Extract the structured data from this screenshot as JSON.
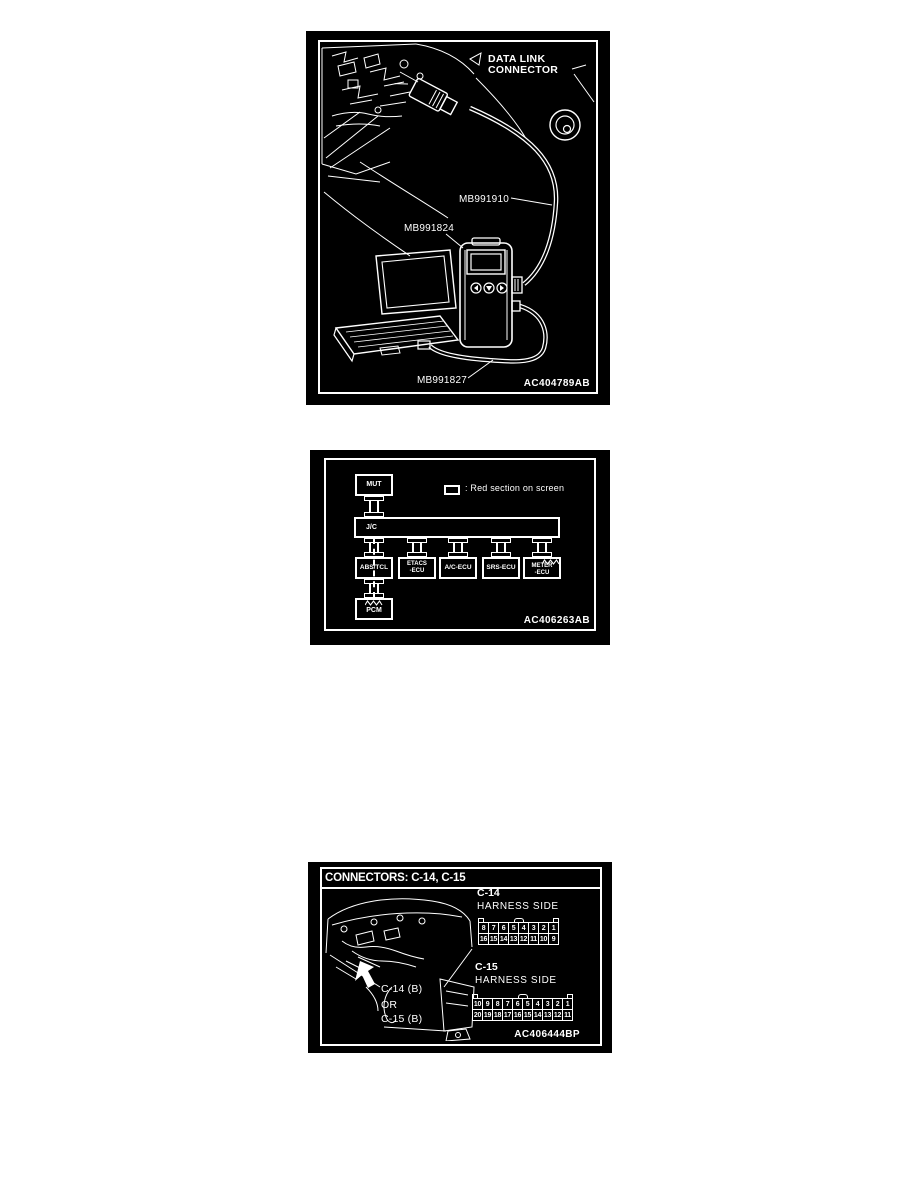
{
  "colors": {
    "page_bg": "#ffffff",
    "panel_bg": "#000000",
    "line": "#ffffff"
  },
  "figure1": {
    "dlc_line1": "DATA LINK",
    "dlc_line2": "CONNECTOR",
    "label_mb991910": "MB991910",
    "label_mb991824": "MB991824",
    "label_mb991827": "MB991827",
    "code": "AC404789AB"
  },
  "figure2": {
    "legend": ": Red section on screen",
    "code": "AC406263AB",
    "boxes": {
      "mut": "MUT",
      "jc": "J/C",
      "abs_tcl": "ABS/TCL",
      "etacs": "ETACS\n-ECU",
      "ac": "A/C-ECU",
      "srs": "SRS-ECU",
      "meter": "METER\n-ECU",
      "pcm": "PCM"
    }
  },
  "figure3": {
    "title": "CONNECTORS: C-14, C-15",
    "code": "AC406444BP",
    "c14": {
      "name": "C-14",
      "side": "HARNESS SIDE",
      "row1": [
        "8",
        "7",
        "6",
        "5",
        "4",
        "3",
        "2",
        "1"
      ],
      "row2": [
        "16",
        "15",
        "14",
        "13",
        "12",
        "11",
        "10",
        "9"
      ]
    },
    "c15": {
      "name": "C-15",
      "side": "HARNESS SIDE",
      "row1": [
        "10",
        "9",
        "8",
        "7",
        "6",
        "5",
        "4",
        "3",
        "2",
        "1"
      ],
      "row2": [
        "20",
        "19",
        "18",
        "17",
        "16",
        "15",
        "14",
        "13",
        "12",
        "11"
      ]
    },
    "callout_c14": "C-14 (B)",
    "callout_or": "OR",
    "callout_c15": "C-15 (B)"
  }
}
